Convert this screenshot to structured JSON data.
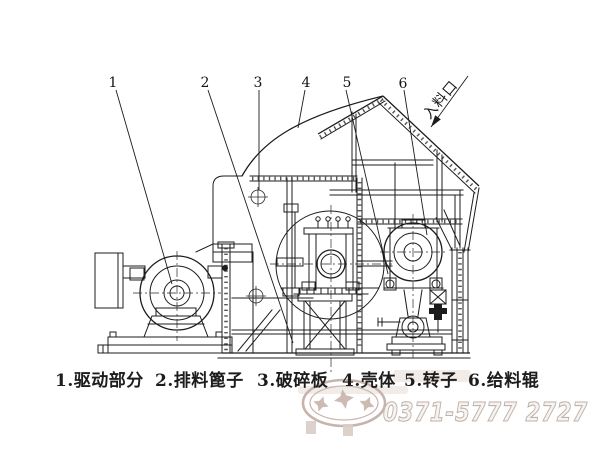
{
  "colors": {
    "line": "#1c1c1c",
    "watermark_outline": "#c6b4ac",
    "phone_fill": "#f7f3f0",
    "phone_stroke": "#bfb2aa"
  },
  "callouts": [
    "1",
    "2",
    "3",
    "4",
    "5",
    "6"
  ],
  "feed_inlet": "入料口",
  "caption": {
    "items": [
      "1.驱动部分",
      "2.排料篦子",
      "3.破碎板",
      "4.壳体",
      "5.转子",
      "6.给料辊"
    ]
  },
  "watermark": {
    "phone": "0371-5777 2727"
  }
}
